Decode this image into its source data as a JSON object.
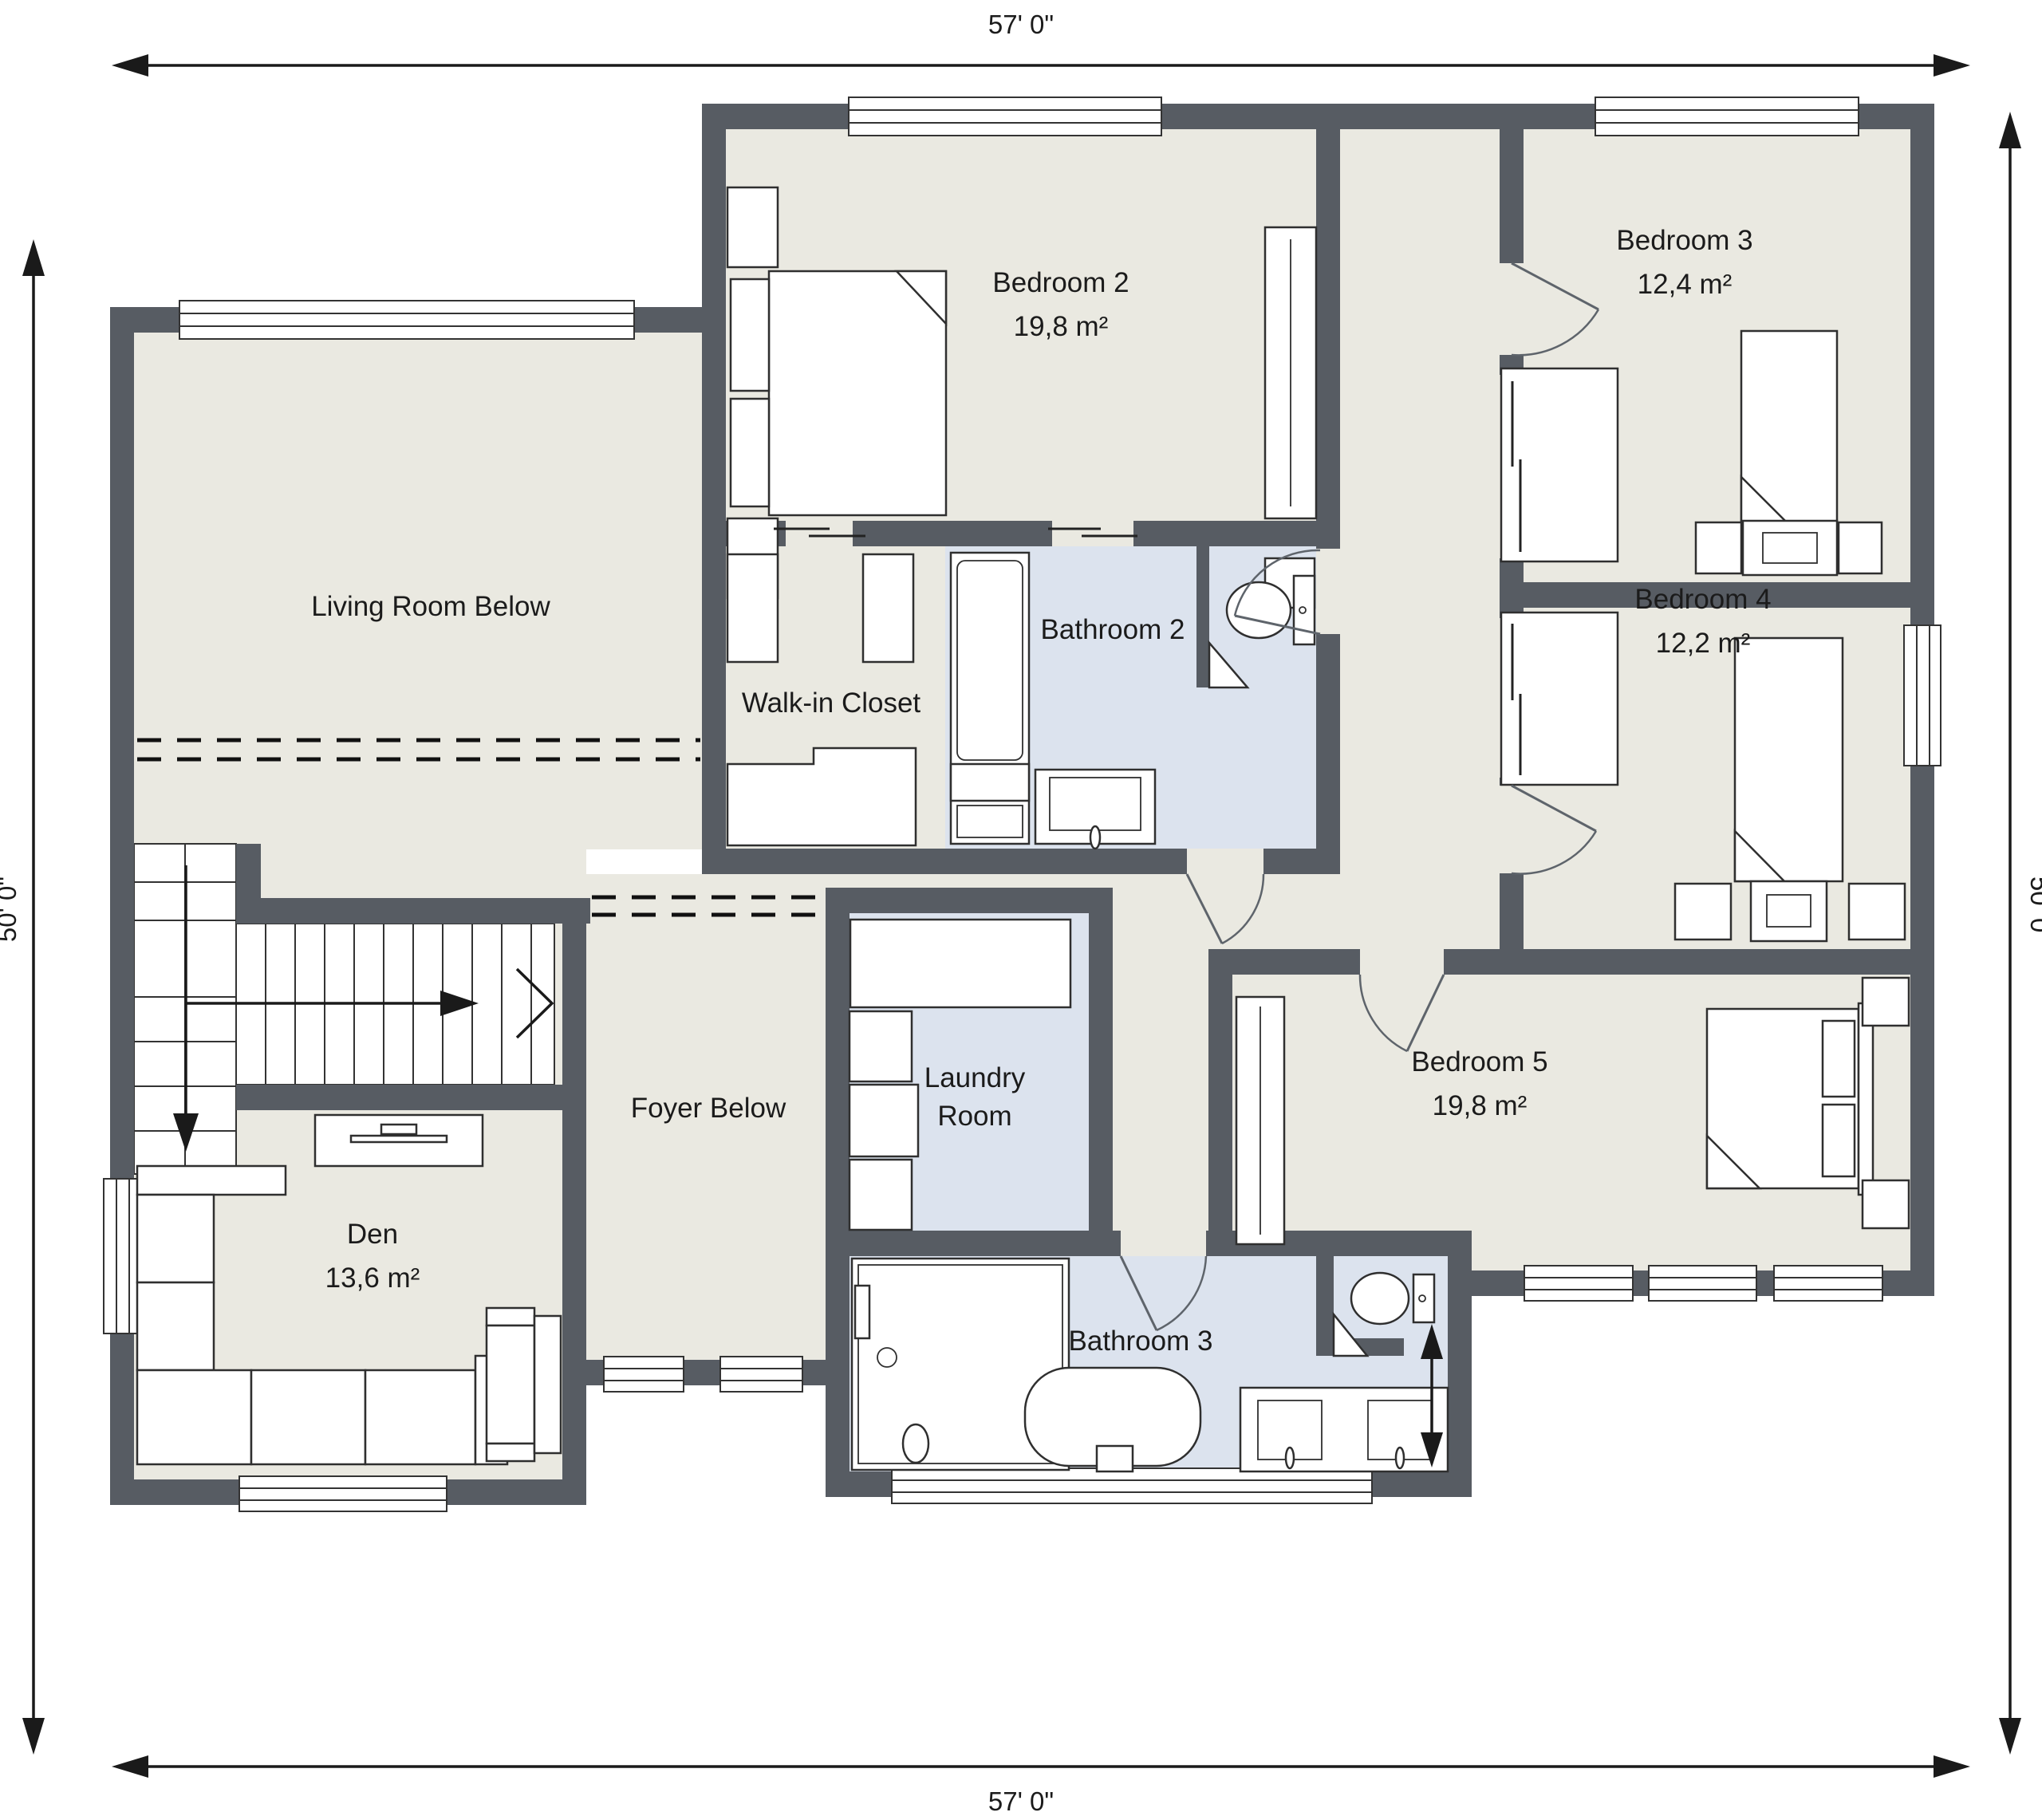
{
  "dimensions": {
    "top": "57' 0\"",
    "bottom": "57' 0\"",
    "left": "50' 0\"",
    "right": "50' 0\""
  },
  "rooms": {
    "living_room": {
      "label": "Living Room Below"
    },
    "bedroom2": {
      "label": "Bedroom 2",
      "area": "19,8 m²"
    },
    "bedroom3": {
      "label": "Bedroom 3",
      "area": "12,4 m²"
    },
    "bedroom4": {
      "label": "Bedroom 4",
      "area": "12,2 m²"
    },
    "bedroom5": {
      "label": "Bedroom 5",
      "area": "19,8 m²"
    },
    "walk_in_closet": {
      "label": "Walk-in Closet"
    },
    "bathroom2": {
      "label": "Bathroom 2"
    },
    "bathroom3": {
      "label": "Bathroom 3"
    },
    "laundry": {
      "label_line1": "Laundry",
      "label_line2": "Room"
    },
    "foyer": {
      "label": "Foyer Below"
    },
    "den": {
      "label": "Den",
      "area": "13,6 m²"
    }
  },
  "colors": {
    "wall": "#575c63",
    "floor": "#eae9e1",
    "wet_floor": "#dce3ee",
    "outline": "#2f2f2f",
    "background": "#ffffff",
    "dashed": "#111111"
  }
}
